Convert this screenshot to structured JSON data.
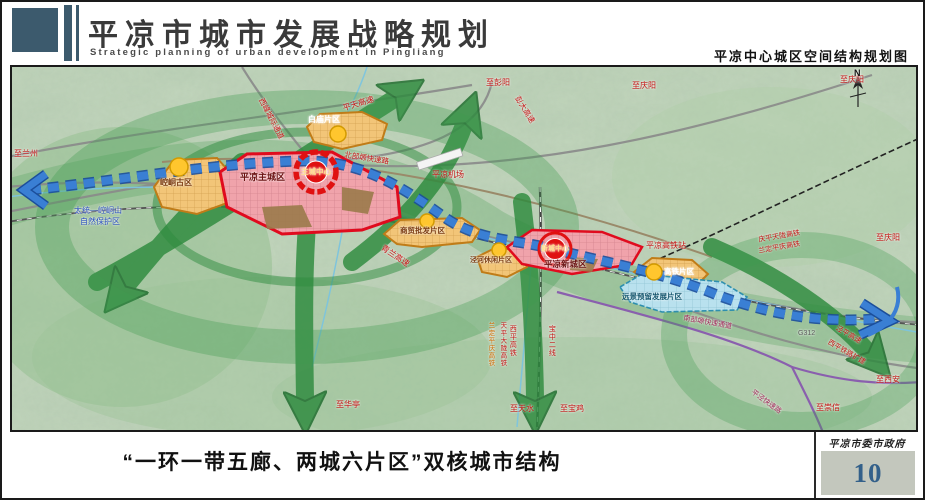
{
  "header": {
    "title": "平凉市城市发展战略规划",
    "subtitle": "Strategic planning of urban development in Pingliang",
    "map_caption": "平凉中心城区空间结构规划图"
  },
  "footer": {
    "caption": "“一环一带五廊、两城六片区”双核城市结构",
    "agency": "平凉市委市政府",
    "page_number": "10"
  },
  "legend_colors": {
    "urban_core_red": "#e00b1e",
    "district_orange": "#f2c578",
    "reserve_blue": "#b9e1ee",
    "corridor_green": "#2e8b3e",
    "axis_blue": "#2f74cf",
    "header_accent": "#3c5a6d",
    "page_number_blue": "#33608a"
  },
  "map": {
    "labels": [
      {
        "name": "to-lanzhou-label",
        "text": "至兰州",
        "x": 2,
        "y": 83,
        "size": 8,
        "color": "#c41111"
      },
      {
        "name": "xifeng-intercity-corridor-label",
        "text": "西峰城际通道",
        "x": 252,
        "y": 30,
        "size": 7.5,
        "color": "#c41111",
        "rotate": 62
      },
      {
        "name": "pingtian-expressway-label",
        "text": "平天高速",
        "x": 330,
        "y": 38,
        "size": 8,
        "color": "#c41111",
        "rotate": -17
      },
      {
        "name": "north-plateau-expressway-label",
        "text": "北部塬快速路",
        "x": 333,
        "y": 84,
        "size": 7.5,
        "color": "#c41111",
        "rotate": 9
      },
      {
        "name": "pingliang-airport-label",
        "text": "平凉机场",
        "x": 420,
        "y": 104,
        "size": 8,
        "color": "#c41111"
      },
      {
        "name": "qinglan-expressway-label",
        "text": "青兰高速",
        "x": 372,
        "y": 177,
        "size": 8,
        "color": "#c41111",
        "rotate": 34
      },
      {
        "name": "baimiao-district-label",
        "text": "白庙片区",
        "x": 296,
        "y": 49,
        "size": 8,
        "color": "#ffffff",
        "bold": true
      },
      {
        "name": "kongtong-ancient-district-label",
        "text": "崆峒古区",
        "x": 148,
        "y": 112,
        "size": 8,
        "color": "#7a3a10",
        "bold": true
      },
      {
        "name": "main-city-label",
        "text": "平凉主城区",
        "x": 228,
        "y": 106,
        "size": 9,
        "color": "#6b1212",
        "bold": true
      },
      {
        "name": "main-core-label",
        "text": "主城中心",
        "x": 304,
        "y": 105,
        "size": 7.5,
        "color": "#ffe089",
        "center": true,
        "bold": true
      },
      {
        "name": "trade-wholesale-district-label",
        "text": "商贸批发片区",
        "x": 388,
        "y": 160,
        "size": 7.5,
        "color": "#7a3a10",
        "bold": true
      },
      {
        "name": "jinghe-leisure-district-label",
        "text": "泾河休闲片区",
        "x": 458,
        "y": 190,
        "size": 7,
        "color": "#7a3a10",
        "bold": true
      },
      {
        "name": "new-city-label",
        "text": "平凉新城区",
        "x": 532,
        "y": 193,
        "size": 8.5,
        "color": "#6b1212",
        "bold": true
      },
      {
        "name": "new-core-label",
        "text": "新城中心",
        "x": 543,
        "y": 182,
        "size": 7,
        "color": "#ffe089",
        "center": true,
        "bold": true
      },
      {
        "name": "hsr-station-label",
        "text": "平凉高铁站",
        "x": 634,
        "y": 175,
        "size": 8,
        "color": "#c41111"
      },
      {
        "name": "hsr-district-label",
        "text": "高铁片区",
        "x": 652,
        "y": 201,
        "size": 7.5,
        "color": "#ffffff",
        "bold": true
      },
      {
        "name": "reserve-district-label",
        "text": "远景预留发展片区",
        "x": 610,
        "y": 226,
        "size": 7.5,
        "color": "#15566e",
        "bold": true
      },
      {
        "name": "qingping-tianlong-hsr-label",
        "text": "庆平天陇高铁",
        "x": 746,
        "y": 170,
        "size": 7,
        "color": "#c41111",
        "rotate": -10
      },
      {
        "name": "landing-pingqing-hsr-label",
        "text": "兰定平庆高铁",
        "x": 746,
        "y": 181,
        "size": 7,
        "color": "#c41111",
        "rotate": -10
      },
      {
        "name": "to-qingyang-top-label",
        "text": "至庆阳",
        "x": 620,
        "y": 15,
        "size": 8,
        "color": "#c41111"
      },
      {
        "name": "to-qingyang-corner-label",
        "text": "至庆阳",
        "x": 828,
        "y": 9,
        "size": 8,
        "color": "#c41111"
      },
      {
        "name": "to-qingyang-right-label",
        "text": "至庆阳",
        "x": 864,
        "y": 167,
        "size": 8,
        "color": "#c41111"
      },
      {
        "name": "to-pengyang-label",
        "text": "至彭阳",
        "x": 474,
        "y": 12,
        "size": 8,
        "color": "#c41111"
      },
      {
        "name": "pengda-expressway-label",
        "text": "彭大高速",
        "x": 508,
        "y": 28,
        "size": 7.5,
        "color": "#c41111",
        "rotate": 58
      },
      {
        "name": "south-plateau-corridor-label",
        "text": "南部塬快速通道",
        "x": 672,
        "y": 248,
        "size": 7,
        "color": "#a02858",
        "rotate": 10
      },
      {
        "name": "pingjing-expressway-label",
        "text": "平泾快速路",
        "x": 742,
        "y": 322,
        "size": 7,
        "color": "#a02858",
        "rotate": 36
      },
      {
        "name": "to-chongxin-label",
        "text": "至崇信",
        "x": 804,
        "y": 337,
        "size": 8,
        "color": "#c41111"
      },
      {
        "name": "to-xian-label",
        "text": "至西安",
        "x": 864,
        "y": 309,
        "size": 8,
        "color": "#c41111"
      },
      {
        "name": "jingping-expressway-label",
        "text": "泾平高速",
        "x": 826,
        "y": 258,
        "size": 7,
        "color": "#c41111",
        "rotate": 30
      },
      {
        "name": "xiping-railway-expansion-label",
        "text": "西平铁路扩建",
        "x": 818,
        "y": 272,
        "size": 7,
        "color": "#c41111",
        "rotate": 30
      },
      {
        "name": "g312-label",
        "text": "G312",
        "x": 786,
        "y": 263,
        "size": 7,
        "color": "#5a5a5a"
      },
      {
        "name": "baozhong-second-line-label",
        "text": "宝中二线",
        "x": 536,
        "y": 258,
        "size": 7,
        "color": "#c41111",
        "vertical": true
      },
      {
        "name": "xiping-hsr-label",
        "text": "西平高铁",
        "x": 497,
        "y": 258,
        "size": 7,
        "color": "#c41111",
        "vertical": true
      },
      {
        "name": "tianping-dalong-hsr-label",
        "text": "天平大陇高铁",
        "x": 486,
        "y": 255,
        "size": 6.5,
        "color": "#c41111",
        "vertical": true
      },
      {
        "name": "landing-pingqing-hsr-vertical-label",
        "text": "兰定平庆高铁",
        "x": 474,
        "y": 255,
        "size": 6.5,
        "color": "#d06a00",
        "vertical": true
      },
      {
        "name": "to-tianshui-label",
        "text": "至天水",
        "x": 498,
        "y": 338,
        "size": 8,
        "color": "#c41111"
      },
      {
        "name": "to-baoji-label",
        "text": "至宝鸡",
        "x": 548,
        "y": 338,
        "size": 8,
        "color": "#c41111"
      },
      {
        "name": "to-huating-label",
        "text": "至华亭",
        "x": 324,
        "y": 334,
        "size": 8,
        "color": "#c41111"
      },
      {
        "name": "nature-reserve-label-line1",
        "text": "太统—崆峒山",
        "x": 62,
        "y": 140,
        "size": 8,
        "color": "#2b4fc0"
      },
      {
        "name": "nature-reserve-label-line2",
        "text": "自然保护区",
        "x": 68,
        "y": 151,
        "size": 8,
        "color": "#2b4fc0"
      },
      {
        "name": "compass-n-label",
        "text": "N",
        "x": 842,
        "y": 2,
        "size": 9,
        "color": "#111111",
        "bold": true
      }
    ]
  }
}
